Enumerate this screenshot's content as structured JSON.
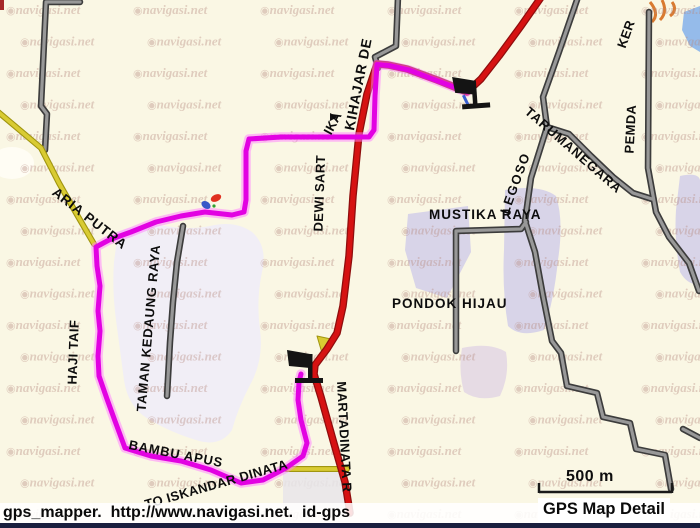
{
  "app": {
    "name": "gps_mapper map view"
  },
  "colors": {
    "background": "#faf7e4",
    "route_track": "#e202e2",
    "route_glow": "#ff7dff",
    "major_road_red": "#d61212",
    "secondary_road_yellow": "#d9cb32",
    "minor_road_gray": "#989898",
    "road_casing": "#3c3c3c",
    "area_lavender": "#d8d4e8",
    "area_light": "#f1eef6",
    "watermark": "#b98e84",
    "bottom_strip": "#1a1f3e"
  },
  "watermark": {
    "logo_icon": "navigasi-logo-icon",
    "logo_glyph": "◉",
    "text": "navigasi.net"
  },
  "map": {
    "street_labels": [
      {
        "id": "kihajar",
        "text": "KIHAJAR DE"
      },
      {
        "id": "dewi-sartika",
        "text": "DEWI SART"
      },
      {
        "id": "dewi-sartika-2",
        "text": "IKA"
      },
      {
        "id": "aria-putra",
        "text": "ARIA PUTRA"
      },
      {
        "id": "haji-taif",
        "text": "HAJI TAIF"
      },
      {
        "id": "taman-kedaung-raya",
        "text": "TAMAN KEDAUNG RAYA"
      },
      {
        "id": "bambu-apus",
        "text": "BAMBU APUS"
      },
      {
        "id": "to-iskandar-dinata",
        "text": "TO ISKANDAR DINATA"
      },
      {
        "id": "martadinata",
        "text": "MARTADINATA R"
      },
      {
        "id": "legoso",
        "text": "LEGOSO"
      },
      {
        "id": "tarumanegara",
        "text": "TARUMANEGARA"
      },
      {
        "id": "pemda",
        "text": "PEMDA"
      },
      {
        "id": "ker",
        "text": "KER"
      },
      {
        "id": "mustika-raya",
        "text": "MUSTIKA RAYA"
      },
      {
        "id": "pondok-hijau",
        "text": "PONDOK HIJAU"
      }
    ],
    "scale": {
      "label": "500 m"
    },
    "markers": [
      {
        "type": "flag",
        "name": "flag-marker-1"
      },
      {
        "type": "flag",
        "name": "flag-marker-2"
      },
      {
        "type": "waypoint",
        "name": "waypoint-icon"
      }
    ]
  },
  "status_bar": {
    "left_text": "gps_mapper.  http://www.navigasi.net.  id-gps",
    "right_text": "GPS Map Detail"
  }
}
